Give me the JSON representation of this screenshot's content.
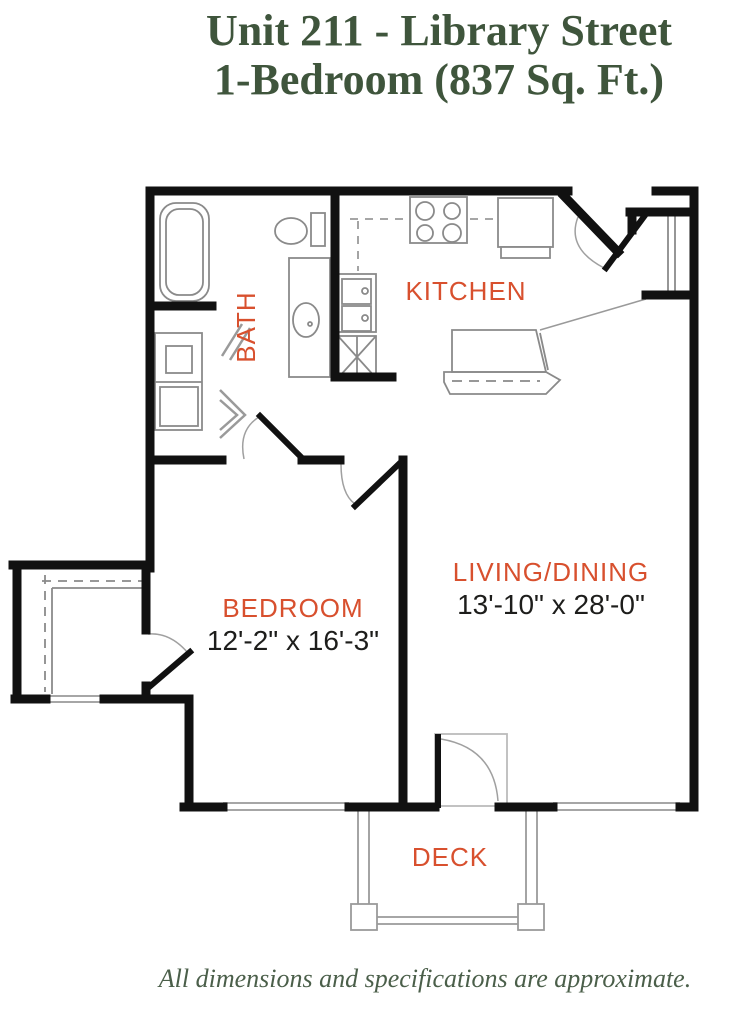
{
  "page": {
    "title_line1": "Unit 211 - Library Street",
    "title_line2": "1-Bedroom (837 Sq. Ft.)",
    "disclaimer": "All dimensions and specifications are approximate."
  },
  "floor_plan": {
    "rooms": [
      {
        "name": "BATH",
        "dimensions": ""
      },
      {
        "name": "KITCHEN",
        "dimensions": ""
      },
      {
        "name": "BEDROOM",
        "dimensions": "12'-2\" x 16'-3\""
      },
      {
        "name": "LIVING/DINING",
        "dimensions": "13'-10\" x 28'-0\""
      },
      {
        "name": "DECK",
        "dimensions": ""
      }
    ]
  },
  "colors": {
    "title_green": "#3f553c",
    "room_label_orange": "#d8502e",
    "dimension_text": "#1d1d1b",
    "wall_black": "#111111",
    "fixture_gray": "#8a8a8a"
  }
}
